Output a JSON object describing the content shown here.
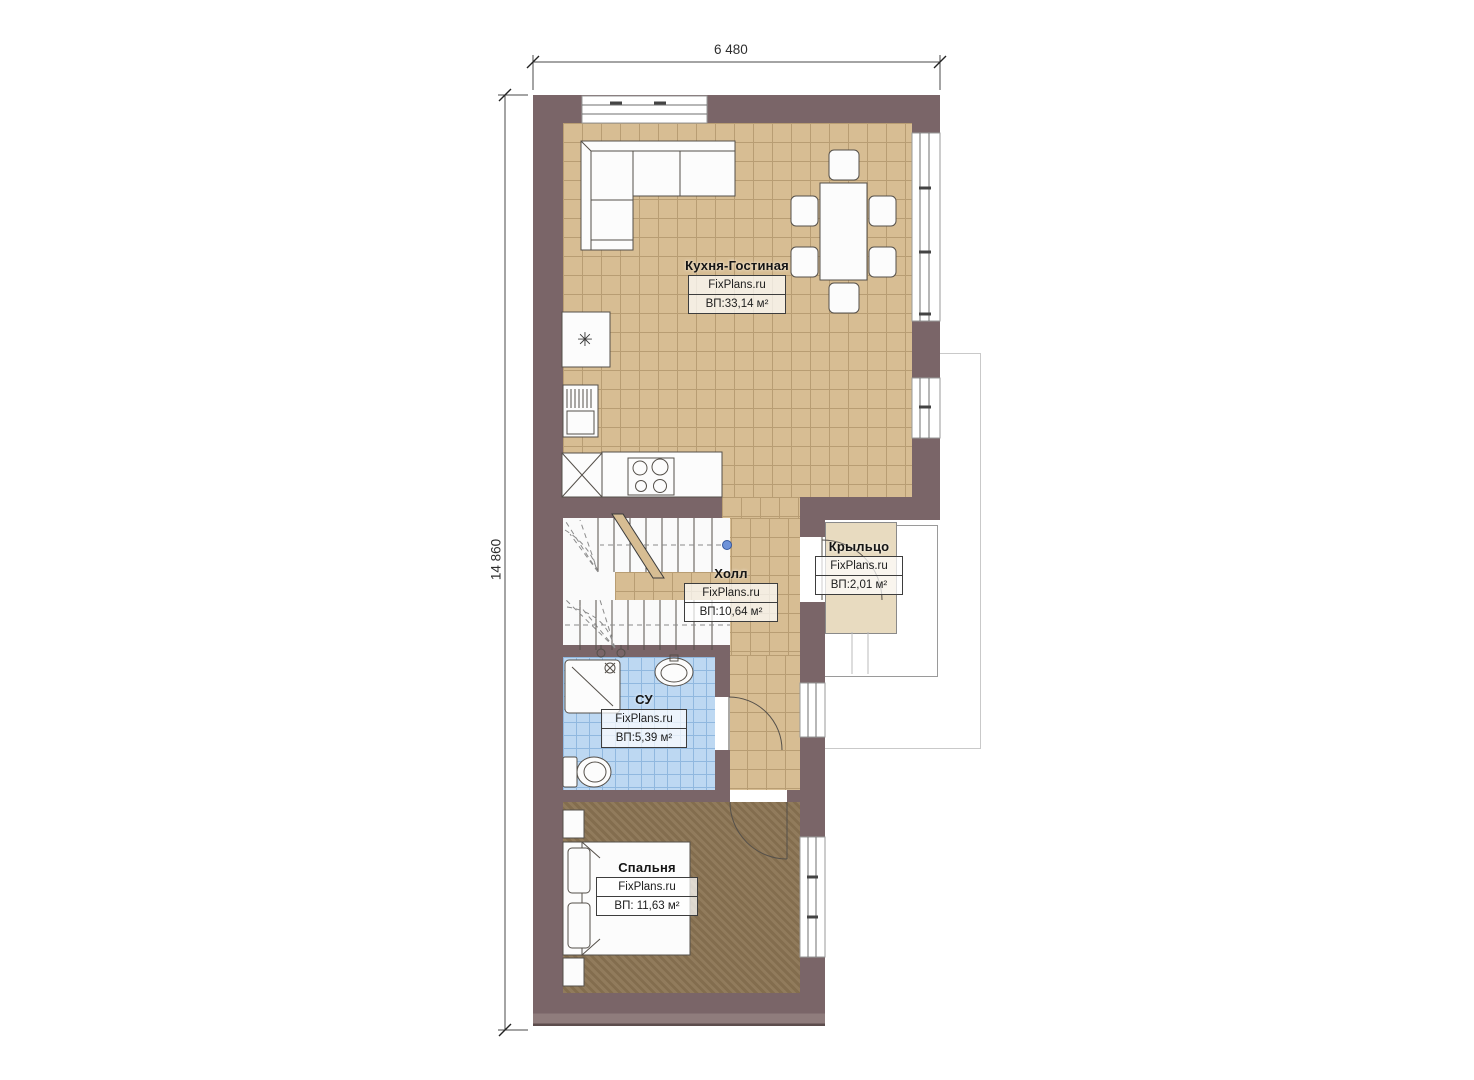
{
  "dimensions": {
    "width": "6 480",
    "height": "14 860"
  },
  "rooms": [
    {
      "id": "kitchen-living",
      "name": "Кухня-Гостиная",
      "brand": "FixPlans.ru",
      "area": "ВП:33,14 м²"
    },
    {
      "id": "hall",
      "name": "Холл",
      "brand": "FixPlans.ru",
      "area": "ВП:10,64 м²"
    },
    {
      "id": "porch",
      "name": "Крыльцо",
      "brand": "FixPlans.ru",
      "area": "ВП:2,01 м²"
    },
    {
      "id": "bathroom",
      "name": "СУ",
      "brand": "FixPlans.ru",
      "area": "ВП:5,39 м²"
    },
    {
      "id": "bedroom",
      "name": "Спальня",
      "brand": "FixPlans.ru",
      "area": "ВП: 11,63 м²"
    }
  ],
  "icons": {
    "fridge_glyph": "✳"
  },
  "colors": {
    "wall": "#7a6568",
    "wall_light": "#8f7c7c",
    "floor_tan": "#d7bd93",
    "grid_tan": "#b89d73",
    "floor_blue": "#bdd8f2",
    "grid_blue": "#90b8df",
    "floor_bedroom": "#8b7453",
    "porch": "#e8dbc0",
    "outline_light": "#c9c9c9",
    "outline_dark": "#9a9a9a",
    "marker_blue": "#6d92d9"
  }
}
